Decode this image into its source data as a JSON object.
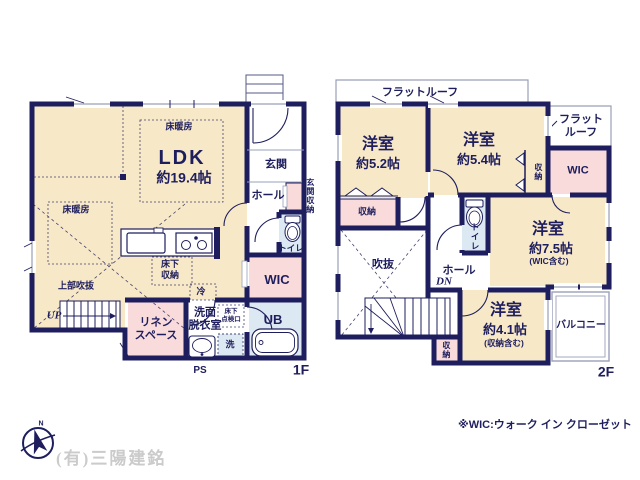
{
  "colors": {
    "wall": "#1e1e5e",
    "room_cream": "#f7e8c7",
    "room_pink": "#f9dbdb",
    "room_blue": "#dce8f2",
    "roof_line": "#9aa0b8",
    "watermark": "#cbcbcb"
  },
  "floor1": {
    "floor_label": "1F",
    "ldk": {
      "name": "LDK",
      "size": "約19.4帖"
    },
    "floor_heating_a": "床暖房",
    "floor_heating_b": "床暖房",
    "entrance": "玄関",
    "hall": "ホール",
    "entrance_storage": "玄関収納",
    "toilet": "トイレ",
    "wic": "WIC",
    "bath": "UB",
    "washer": "洗",
    "washroom": "洗面\n脱衣室",
    "underfloor_storage": "床下\n収納",
    "underfloor_hatch": "床下\n点検口",
    "fridge": "冷",
    "linen": "リネン\nスペース",
    "upper_void": "上部吹抜",
    "stairs_up": "UP",
    "pipe_space": "PS"
  },
  "floor2": {
    "floor_label": "2F",
    "flat_roof_top": "フラットルーフ",
    "flat_roof_right": "フラット\nルーフ",
    "room_a": {
      "name": "洋室",
      "size": "約5.2帖"
    },
    "room_b": {
      "name": "洋室",
      "size": "約5.4帖"
    },
    "room_c": {
      "name": "洋室",
      "size": "約7.5帖",
      "note": "(WIC含む)"
    },
    "room_d": {
      "name": "洋室",
      "size": "約4.1帖",
      "note": "(収納含む)"
    },
    "storage_west": "収納",
    "storage_upper": "収納",
    "storage_south": "収納",
    "wic": "WIC",
    "toilet": "トイレ",
    "hall": "ホール",
    "stairs_down": "DN",
    "void": "吹抜",
    "balcony": "バルコニー"
  },
  "footer": {
    "wic_note": "※WIC:ウォーク イン クローゼット",
    "company": "(有)三陽建銘",
    "compass_north": "N"
  }
}
